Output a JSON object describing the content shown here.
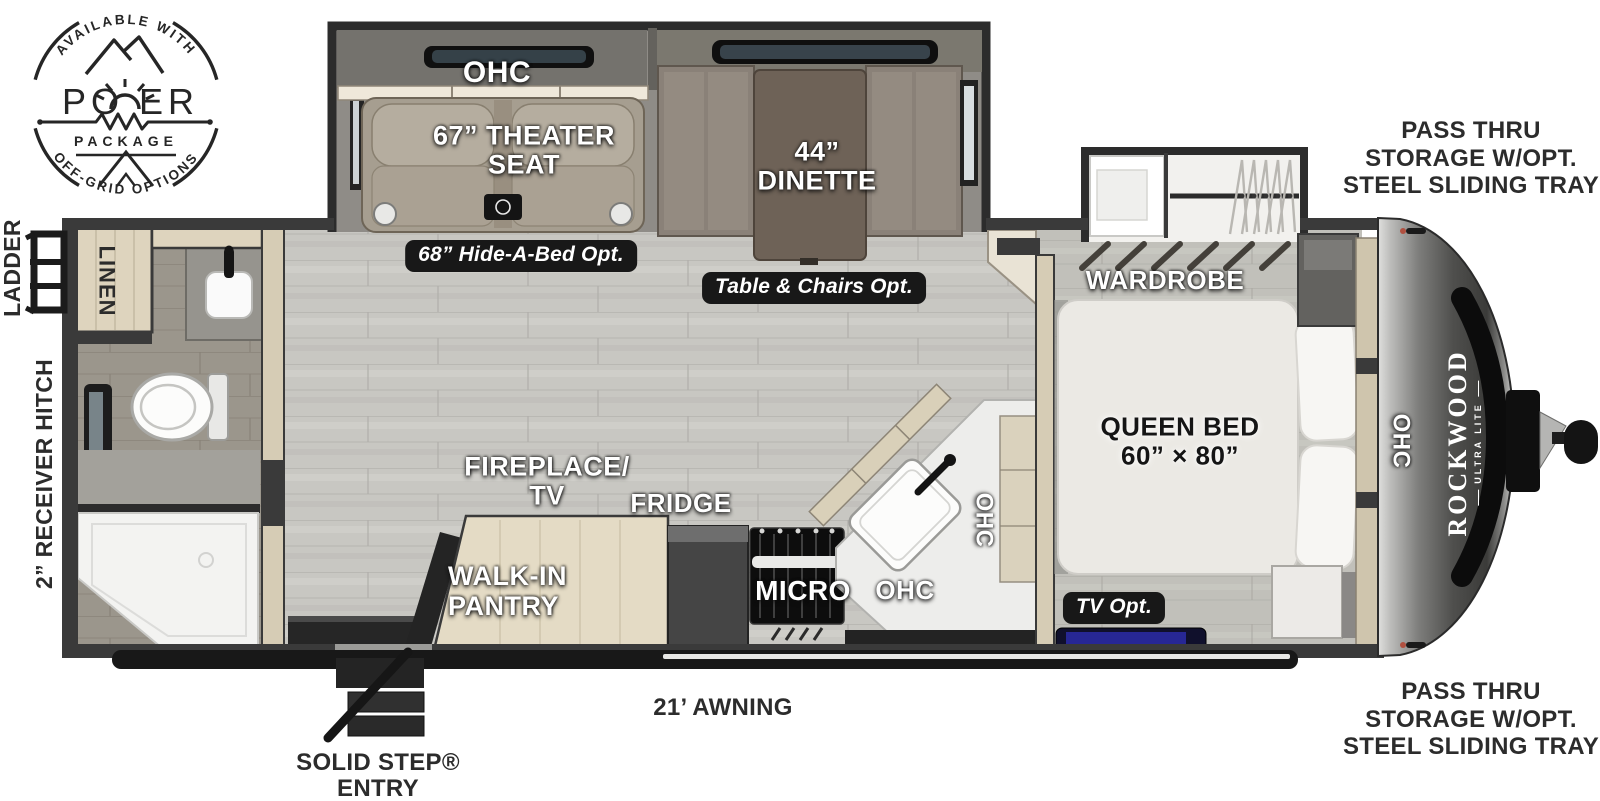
{
  "badge": {
    "available_with": "AVAILABLE WITH",
    "power_po": "PO",
    "power_er": "ER",
    "package": "PACKAGE",
    "off_grid": "OFF-GRID OPTIONS"
  },
  "brand": {
    "name": "ROCKWOOD",
    "sub": "ULTRA LITE"
  },
  "rooms": {
    "ohc_theater": "OHC",
    "theater_seat": "67” THEATER SEAT",
    "dinette": "44” DINETTE",
    "wardrobe": "WARDROBE",
    "queen_bed": "QUEEN BED 60” × 80”",
    "fireplace_tv": "FIREPLACE/ TV",
    "fridge": "FRIDGE",
    "walk_in_pantry": "WALK-IN PANTRY",
    "micro": "MICRO",
    "ohc_kitchen": "OHC",
    "ohc_kitchen_vertical": "OHC",
    "ohc_front": "OHC",
    "linen": "LINEN"
  },
  "options": {
    "hide_a_bed": "68” Hide-A-Bed Opt.",
    "table_chairs": "Table & Chairs Opt.",
    "tv_opt": "TV Opt."
  },
  "exterior": {
    "pass_thru_top": "PASS THRU STORAGE W/OPT. STEEL SLIDING TRAY",
    "pass_thru_bottom": "PASS THRU STORAGE W/OPT. STEEL SLIDING TRAY",
    "awning": "21’ AWNING",
    "solid_step": "SOLID STEP® ENTRY",
    "ladder": "LADDER",
    "receiver_hitch": "2” RECEIVER HITCH"
  },
  "colors": {
    "wall": "#3a3a3a",
    "cabinet": "#ddd3bd",
    "floor": "#c8c7c2",
    "bath_floor": "#9b968c",
    "pill_bg": "#181818",
    "tv_screen": "#2f2fb8",
    "label_white": "#ffffff",
    "label_dark": "#2c2c2c"
  }
}
